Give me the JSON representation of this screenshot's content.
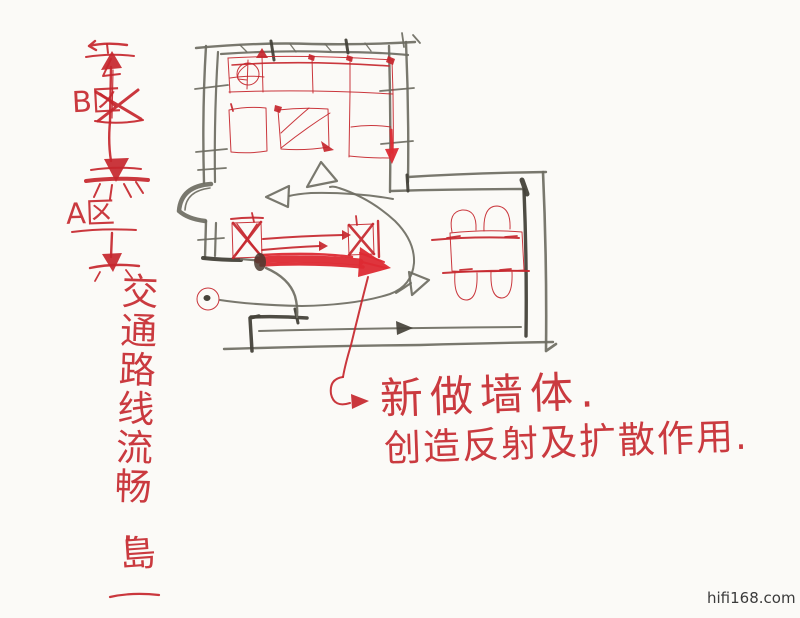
{
  "colors": {
    "paper": "#fbfaf7",
    "red_pen": "#c5262c",
    "red_bright": "#dd2a33",
    "pencil": "#6e6c62",
    "pencil_dark": "#45423a",
    "watermark_color": "#3b3b3b"
  },
  "zone_legend": {
    "zone_b_label": "B区",
    "zone_a_label": "A区"
  },
  "annotations": {
    "route_note": "交通路线流畅.",
    "signature": "島",
    "wall_note_line1": "新做墙体.",
    "wall_note_line2": "创造反射及扩散作用."
  },
  "watermark": "hifi168.com",
  "sketch_elements": [
    "floor-plan-walls",
    "door-swing",
    "sofa-l-shaped",
    "ceiling-symbol-circle",
    "armchair-square",
    "coffee-table-square",
    "speaker-box-left",
    "speaker-box-right",
    "new-wall-thick-line",
    "dining-table",
    "dining-chairs",
    "listening-position-circle",
    "traffic-flow-curves",
    "zone-direction-diagram",
    "leader-arrow-to-note"
  ]
}
